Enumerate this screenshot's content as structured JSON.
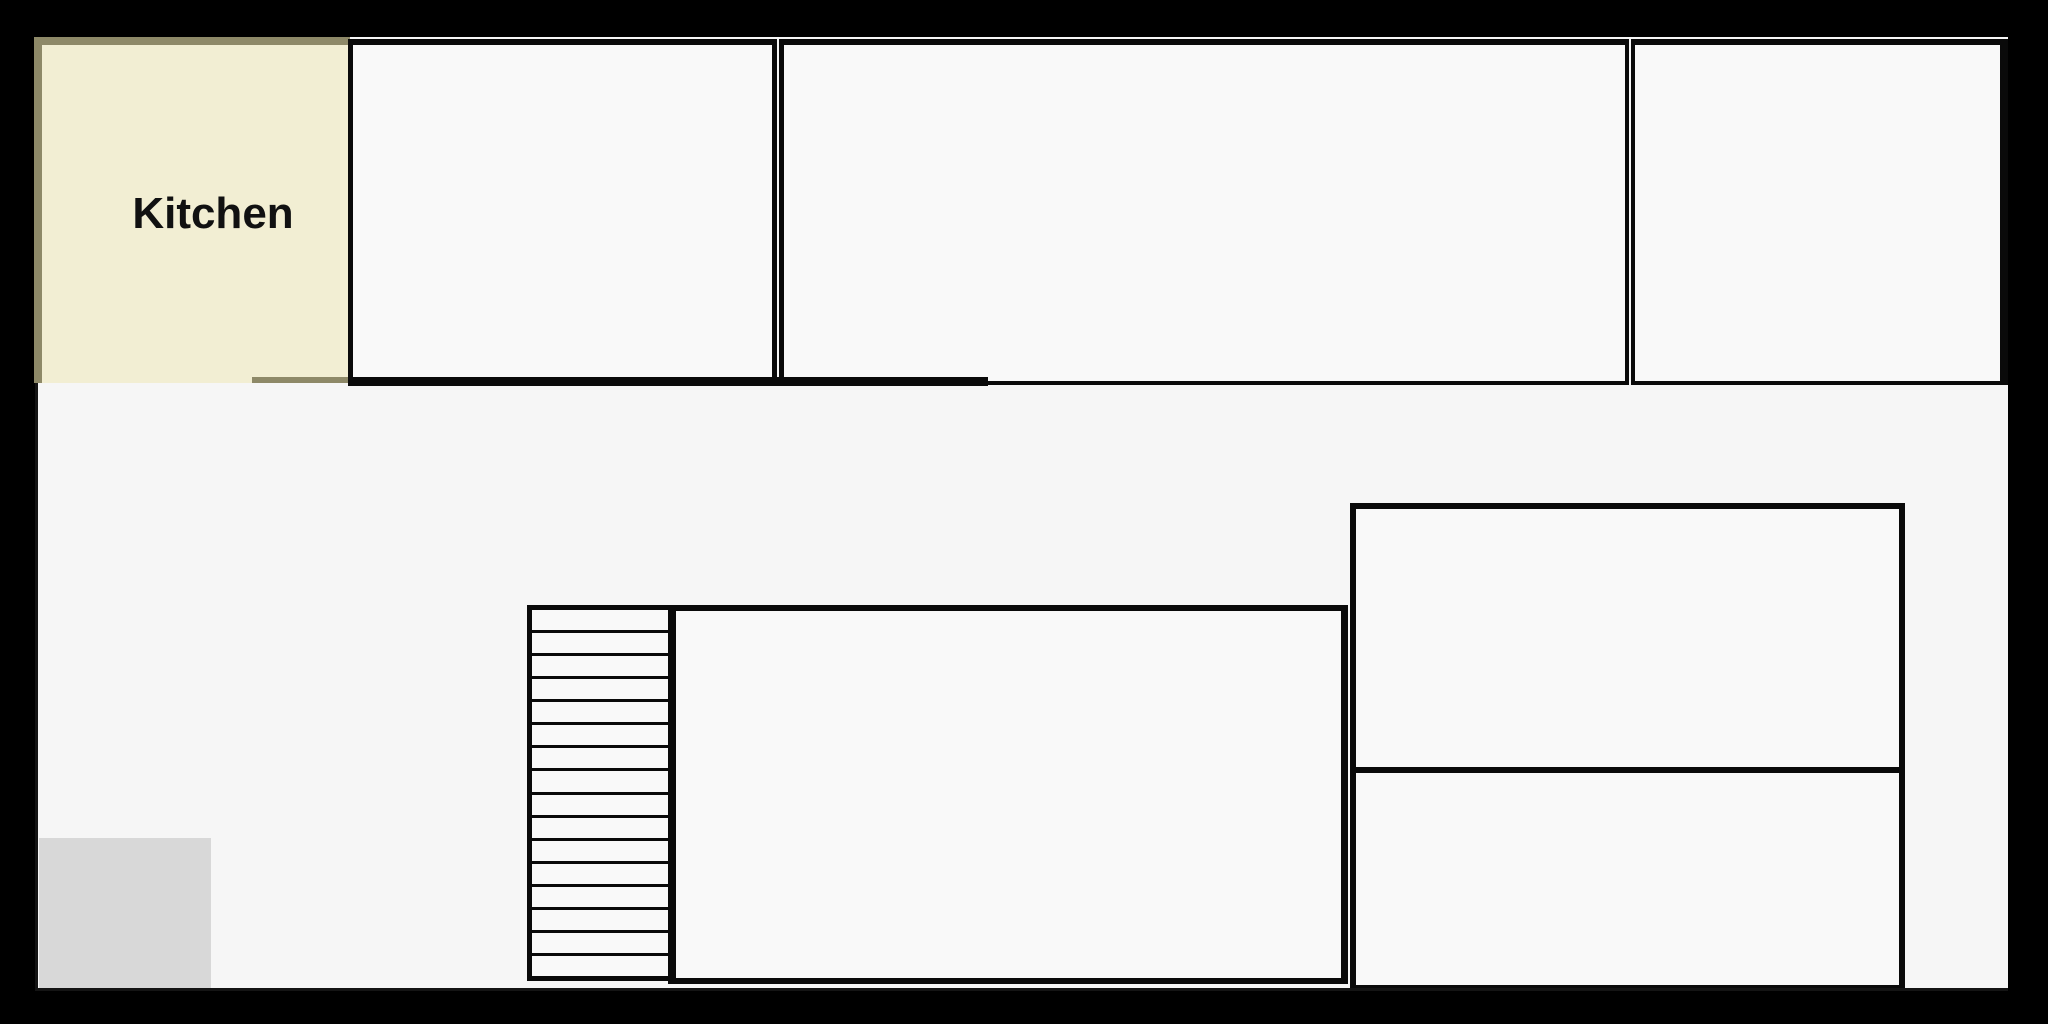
{
  "floor_plan": {
    "rooms": [
      {
        "id": "kitchen",
        "label": "Kitchen"
      },
      {
        "id": "top-room-1",
        "label": ""
      },
      {
        "id": "top-room-2",
        "label": ""
      },
      {
        "id": "top-room-3",
        "label": ""
      },
      {
        "id": "large-lower-room",
        "label": ""
      },
      {
        "id": "right-upper-room",
        "label": ""
      },
      {
        "id": "right-lower-room",
        "label": ""
      }
    ],
    "stairs": {
      "step_count": 16,
      "tread_lines": 15
    },
    "features": {
      "floor_mat": "gray square area at bottom-left"
    }
  },
  "colors": {
    "background_black": "#000000",
    "floor": "#f6f6f6",
    "room_fill": "#f9f9f9",
    "wall": "#0a0a0a",
    "kitchen_fill": "#f2eed3",
    "kitchen_border": "#8e8968",
    "mat_gray": "#d8d8d8",
    "label_text": "#111111"
  }
}
